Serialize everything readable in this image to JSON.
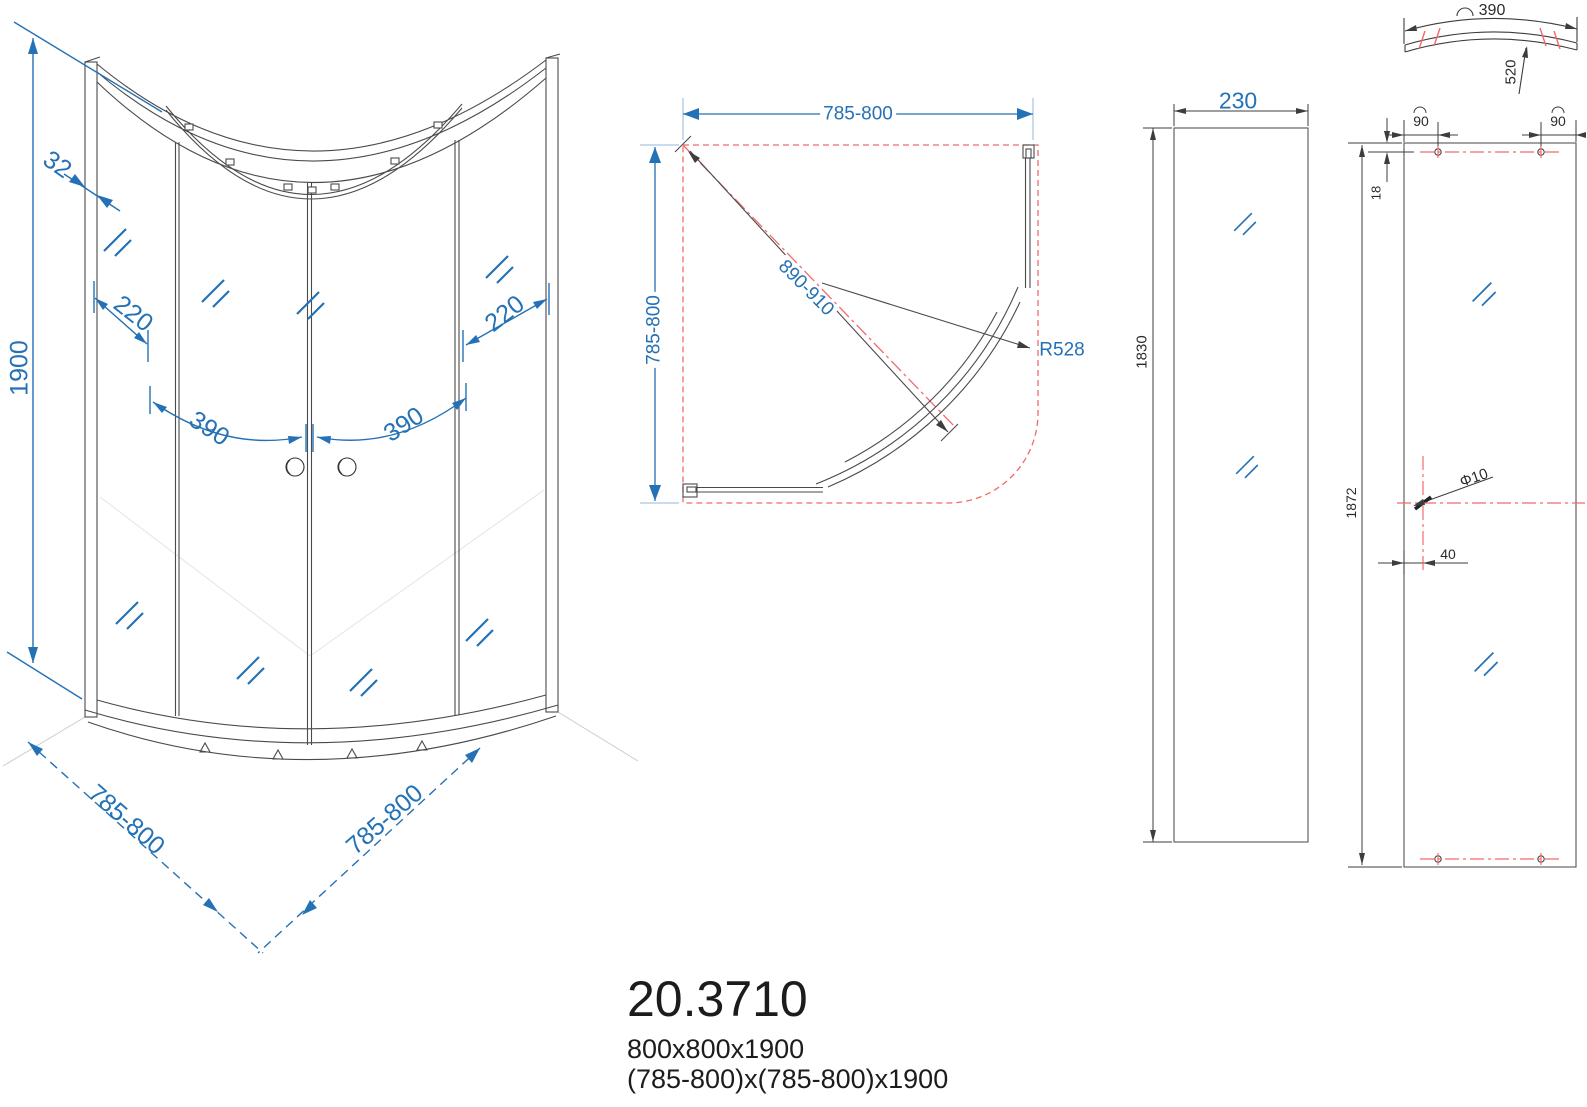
{
  "drawing": {
    "front_view": {
      "dim_height": "1900",
      "dim_profile": "32",
      "dim_adjust_left": "220",
      "dim_adjust_right": "220",
      "dim_door_left": "390",
      "dim_door_right": "390",
      "dim_base_left": "785-800",
      "dim_base_right": "785-800"
    },
    "plan_view": {
      "dim_width": "785-800",
      "dim_depth": "785-800",
      "dim_diagonal": "890-910",
      "dim_radius": "R528"
    },
    "side_panel": {
      "dim_width": "230",
      "dim_height": "1830"
    },
    "door_panel": {
      "dim_arc": "390",
      "dim_arc_depth": "520",
      "dim_hole_left": "90",
      "dim_hole_right": "90",
      "dim_hole_top": "18",
      "dim_height": "1872",
      "dim_hole_diameter": "Φ10",
      "dim_handle_offset": "40"
    },
    "product": {
      "code": "20.3710",
      "size": "800x800x1900",
      "size_range": "(785-800)x(785-800)x1900"
    },
    "colors": {
      "dimension_blue": "#2471b5",
      "extension_blue": "#92bade",
      "centerline_red": "#f26b6b",
      "line_dark": "#4a4a4a"
    }
  }
}
